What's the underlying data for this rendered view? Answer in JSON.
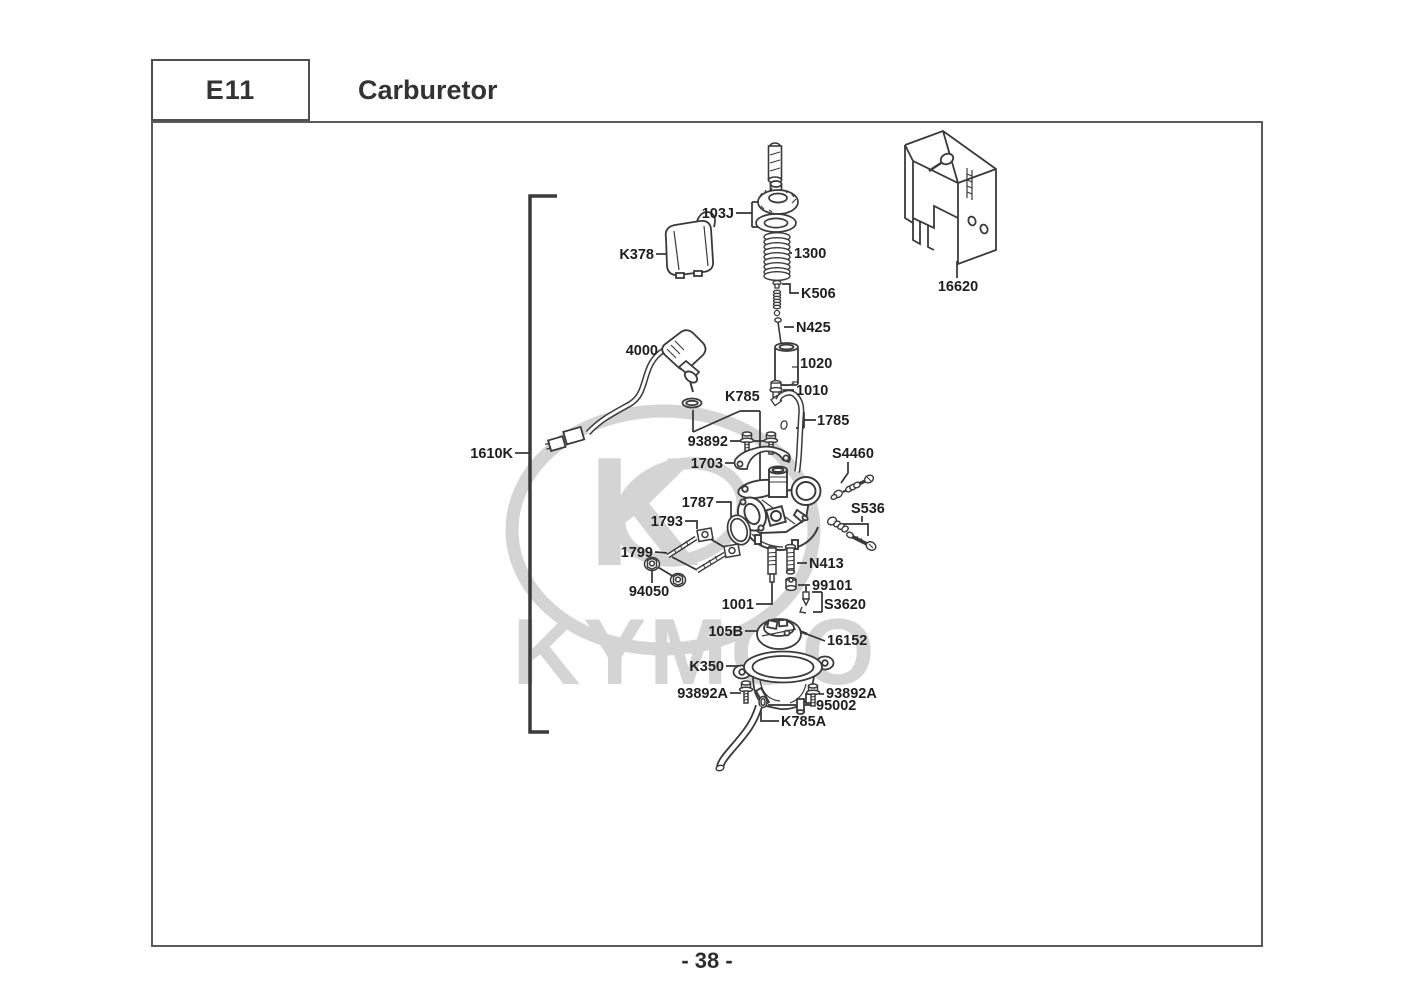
{
  "header": {
    "section_code": "E11",
    "title": "Carburetor"
  },
  "footer": {
    "page_number": "- 38 -"
  },
  "watermark": {
    "logo_letter": "K",
    "brand": "KYMCO"
  },
  "diagram": {
    "labels": {
      "103J": "103J",
      "1300": "1300",
      "K378": "K378",
      "K506": "K506",
      "N425": "N425",
      "4000": "4000",
      "1020": "1020",
      "1010": "1010",
      "K785": "K785",
      "1785": "1785",
      "93892": "93892",
      "1703": "1703",
      "S4460": "S4460",
      "1787": "1787",
      "S536": "S536",
      "1793": "1793",
      "1799": "1799",
      "N413": "N413",
      "99101": "99101",
      "94050": "94050",
      "1001": "1001",
      "S3620": "S3620",
      "105B": "105B",
      "16152": "16152",
      "K350": "K350",
      "93892A_left": "93892A",
      "93892A_right": "93892A",
      "95002": "95002",
      "K785A": "K785A",
      "1610K": "1610K",
      "16620": "16620"
    }
  }
}
